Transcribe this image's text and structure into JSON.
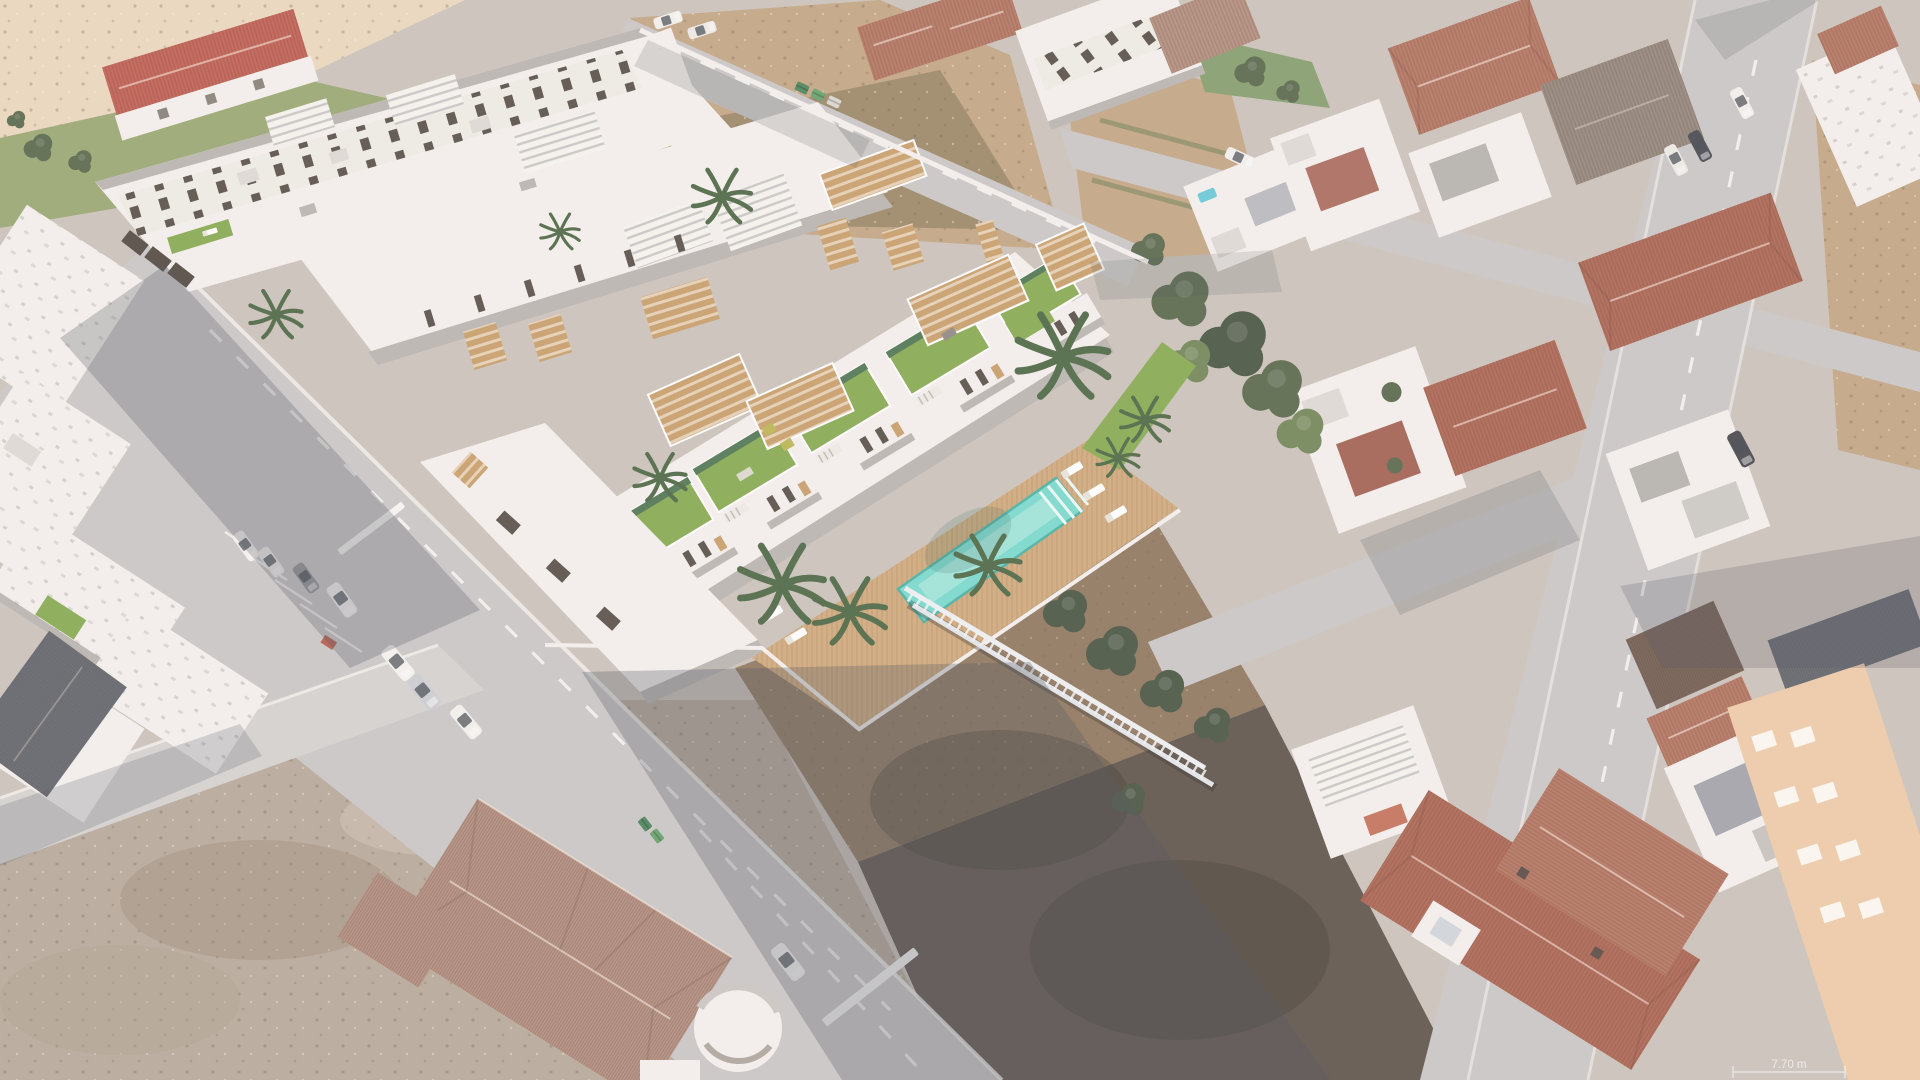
{
  "scene": {
    "type": "aerial-photograph-with-3d-architectural-render",
    "description": "High oblique aerial view of a Spanish coastal town. A 3D-rendered new residential development (white modern townhouses with artificial-grass roofs, wooden pergolas, a communal turquoise lap pool on a timber deck with palm trees) is composited onto vacant dirt plots, surrounded by existing whitewashed houses, terracotta hip roofs, streets with parked cars, zebra crossings and empty brown lots.",
    "annotation": {
      "dimension_label": "7.70 m"
    },
    "development": {
      "front_row_green_roofs": 5,
      "pool": "communal lap pool with entry steps",
      "amenities": [
        "timber pool deck",
        "sun loungers",
        "palm trees",
        "lawn strips",
        "timber pergolas",
        "roof terraces"
      ]
    },
    "environment": {
      "vacant_lots": 3,
      "vehicles": [
        "white cars",
        "white vans",
        "pickup truck",
        "dark SUV",
        "green waste containers"
      ],
      "road_markings": [
        "dashed lane lines",
        "zebra crossings",
        "parking bays"
      ]
    }
  },
  "colors": {
    "base": "#c9c1b7",
    "sand": "#e9d6ba",
    "lawn": "#95a46b",
    "dirt_tan": "#bfa17c",
    "dirt_olive": "#897a57",
    "dirt_taupe": "#b3a595",
    "dirt_dark": "#554b40",
    "dirt_warm": "#8a7156",
    "road": "#c7c5c3",
    "road_light": "#d3d1cf",
    "white_wall": "#f4f1ec",
    "white_face": "#ddd9d3",
    "dark_face": "#b5b1ad",
    "window_dark": "#4f473f",
    "wood": "#c59a62",
    "green_roof": "#7fa848",
    "green_dark": "#47704a",
    "pool": "#72d9cc",
    "pool_light": "#a3e7dc",
    "deck": "#cda675",
    "terracotta": "#b3705a",
    "terracotta_red": "#ab5f4b",
    "terracotta_gray": "#b08a79",
    "roof_gray": "#8f8276",
    "roof_brown": "#6a5548",
    "slate": "#5a6068",
    "tree": "#4e6040",
    "tree_dark": "#3e4c38",
    "tree_light": "#6a8150",
    "palm": "#42603a",
    "peach": "#ecc9a4",
    "red_roof": "#c0574a",
    "shadow": "#3c4250",
    "marking": "#f6f5f2"
  }
}
